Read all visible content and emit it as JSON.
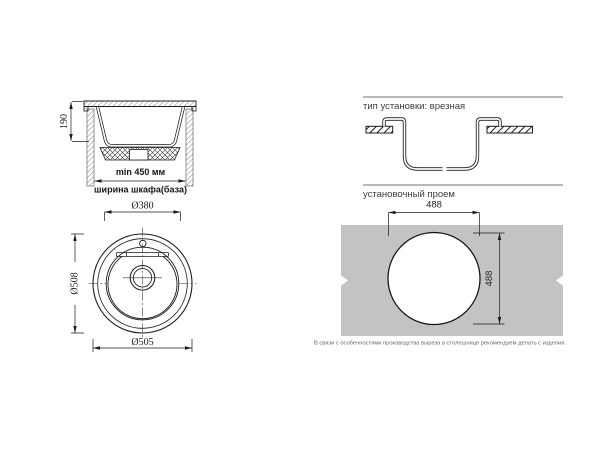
{
  "figures": {
    "section": {
      "depth": "190",
      "min_width": "min 450 мм",
      "cabinet_width": "ширина шкафа(база)"
    },
    "plan": {
      "top_diameter": "Ø380",
      "side_diameter": "Ø508",
      "bottom_diameter": "Ø505"
    },
    "mount": {
      "heading": "тип установки: врезная"
    },
    "cutout": {
      "heading": "установочный проем",
      "width": "488",
      "height": "488",
      "note": "В связи с особенностями производства выреза в столешнице рекомендуем делать с изделия."
    }
  },
  "colors": {
    "line": "#1c1c1c",
    "countertop_fill": "#c3c3c3",
    "rule": "#8f8f8f",
    "note_text": "#666666"
  }
}
